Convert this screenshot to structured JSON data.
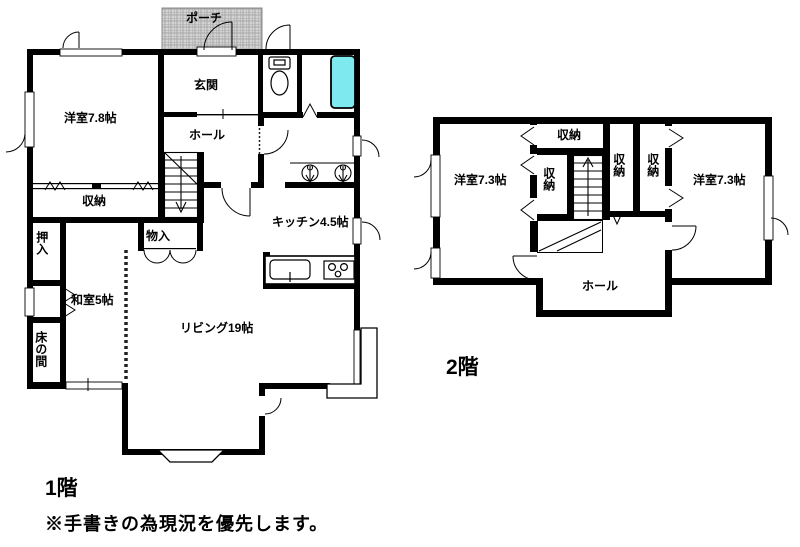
{
  "floor1": {
    "caption": "1階",
    "rooms": {
      "porch": "ポーチ",
      "entrance": "玄関",
      "hall": "ホール",
      "western_room": "洋室7.8帖",
      "storage": "収納",
      "oshiire": "押入",
      "monoire": "物入",
      "japanese_room": "和室5帖",
      "tokonoma": "床の間",
      "living": "リビング19帖",
      "kitchen": "キッチン4.5帖"
    }
  },
  "floor2": {
    "caption": "2階",
    "rooms": {
      "western_room_left": "洋室7.3帖",
      "closet_top": "収納",
      "closet_stairs": "収納",
      "closet_mid_1": "収納",
      "closet_mid_2": "収納",
      "western_room_right": "洋室7.3帖",
      "hall": "ホール"
    }
  },
  "note": "※手書きの為現況を優先します。",
  "colors": {
    "wall": "#000000",
    "bathtub_fill": "#7fe9f0",
    "porch_fill": "#d4d4d4"
  }
}
